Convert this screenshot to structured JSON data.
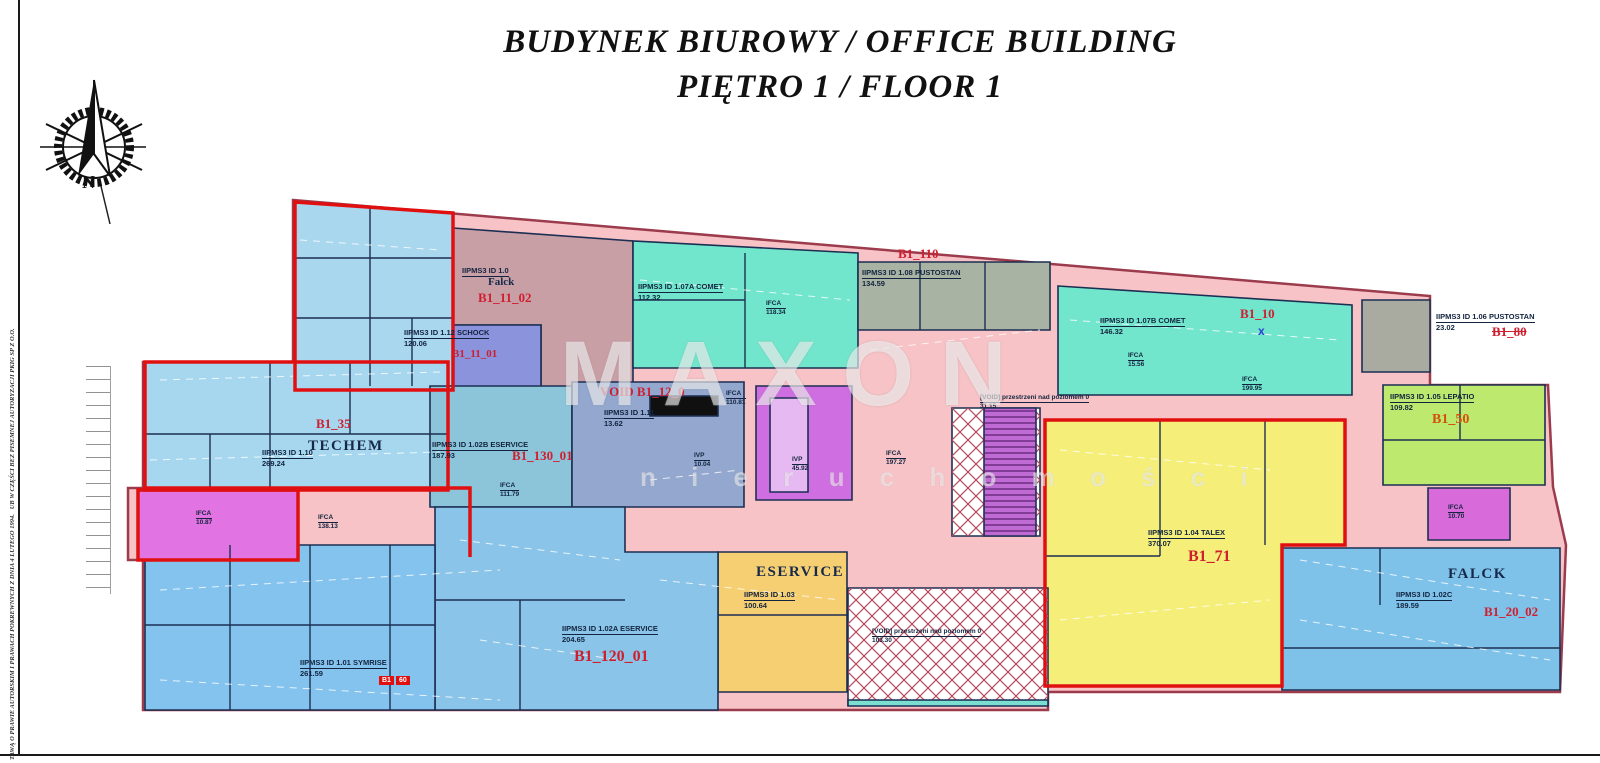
{
  "header": {
    "title_line1": "BUDYNEK BIUROWY / OFFICE BUILDING",
    "title_line2": "PIĘTRO 1 / FLOOR 1"
  },
  "compass": {
    "north_label": "N"
  },
  "side_note": {
    "line1": "TAWĄ O PRAWIE AUTORSKIM I PRAWACH POKREWNYCH Z DNIA 4 LUTEGO 1994.",
    "line2": "UB W CZĘŚCI BEZ PISEMNEJ AUTORYZACJI PKIG SP Z O.O."
  },
  "watermark": {
    "line1": "MAXON",
    "line2": "n i e r u c h o m o ś c i"
  },
  "colors": {
    "wall": "#1c2f52",
    "outline_red": "#e01010",
    "base_pink": "#f7c3c7",
    "teal": "#72e6cc",
    "yellow": "#f5ef7a",
    "gold": "#f6cf72",
    "green": "#bdea6e",
    "magenta": "#cf6ee0",
    "blue": "#85c3ef"
  },
  "plan": {
    "zones": [
      {
        "name": "base-building",
        "fill": "#f7c3c7",
        "stroke": "#9b3b4b",
        "sw": 2.5,
        "points": "293,200 1430,296 1430,385 1548,385 1553,487 1566,545 1560,692 1048,692 1048,710 143,710 143,560 128,560 128,488 143,488 143,362 293,362"
      },
      {
        "name": "cluster-nw",
        "fill": "#a9d7ee",
        "points": "295,202 453,213 453,386 295,386"
      },
      {
        "name": "falck-1",
        "fill": "#c99fa6",
        "points": "453,228 633,241 633,388 541,388 541,325 453,325"
      },
      {
        "name": "comet-a",
        "fill": "#72e6cc",
        "points": "633,241 858,253 858,368 633,368"
      },
      {
        "name": "schock",
        "fill": "#8a93dc",
        "points": "453,325 541,325 541,388 453,388"
      },
      {
        "name": "pustostan-108",
        "fill": "#a9b3a4",
        "points": "858,262 1050,262 1050,330 858,330"
      },
      {
        "name": "comet-b",
        "fill": "#72e6cc",
        "points": "1058,286 1352,305 1352,395 1058,395"
      },
      {
        "name": "pustostan-106",
        "fill": "#a9aba0",
        "points": "1362,300 1430,300 1430,372 1362,372"
      },
      {
        "name": "lepatio",
        "fill": "#bdea6e",
        "points": "1383,385 1545,385 1545,485 1383,485"
      },
      {
        "name": "techem",
        "fill": "#a6d7ef",
        "points": "145,362 448,362 448,490 145,490"
      },
      {
        "name": "eservice-b",
        "fill": "#8cc5d9",
        "points": "430,386 572,386 572,507 430,507"
      },
      {
        "name": "void-12",
        "fill": "#93a7cf",
        "points": "572,382 744,382 744,507 572,507"
      },
      {
        "name": "elevator-block",
        "fill": "#101010",
        "points": "650,396 718,396 718,416 650,416"
      },
      {
        "name": "core-stairs",
        "fill": "#cf6ee0",
        "points": "756,386 852,386 852,500 756,500"
      },
      {
        "name": "core-stairs-inner",
        "fill": "#e7b9f2",
        "points": "770,398 808,398 808,492 770,492"
      },
      {
        "name": "void-hatch-top",
        "fill": "#ffffff",
        "pattern": "xh",
        "points": "952,408 1040,408 1040,536 952,536"
      },
      {
        "name": "stair-top",
        "fill": "#c06ad4",
        "pattern": "st",
        "points": "984,408 1036,408 1036,536 984,536"
      },
      {
        "name": "talex",
        "fill": "#f5ef7a",
        "points": "1045,420 1345,420 1345,545 1282,545 1282,686 1045,686"
      },
      {
        "name": "ifca-1070",
        "fill": "#d96ad9",
        "points": "1428,488 1510,488 1510,540 1428,540"
      },
      {
        "name": "falck-c",
        "fill": "#7fc2e9",
        "points": "1282,548 1560,548 1560,690 1282,690"
      },
      {
        "name": "eservice-103",
        "fill": "#f6cf72",
        "points": "718,552 847,552 847,692 718,692"
      },
      {
        "name": "eservice-a",
        "fill": "#8ac4e8",
        "points": "435,507 625,507 625,552 718,552 718,710 435,710"
      },
      {
        "name": "symrise",
        "fill": "#85c3ef",
        "points": "145,545 435,545 435,710 145,710"
      },
      {
        "name": "stairs-left",
        "fill": "#e273e2",
        "points": "138,490 298,490 298,560 138,560"
      },
      {
        "name": "void-hatch-bottom",
        "fill": "#ffffff",
        "pattern": "xh",
        "points": "848,588 1048,588 1048,705 848,705"
      },
      {
        "name": "teal-strip",
        "fill": "#7adfd0",
        "points": "848,700 1048,700 1048,706 848,706"
      }
    ],
    "red_outlines": [
      "295,202 453,213 453,390 295,390",
      "145,362 448,362 448,490 145,490",
      "1045,420 1345,420 1345,545 1282,545 1282,686 1045,686",
      "138,490 298,490 298,560 138,560"
    ],
    "red_lines": [
      "143,488 470,488 470,557"
    ],
    "partitions": [
      [
        370,
        206,
        370,
        386
      ],
      [
        295,
        258,
        453,
        258
      ],
      [
        295,
        318,
        453,
        318
      ],
      [
        412,
        318,
        412,
        386
      ],
      [
        270,
        362,
        270,
        490
      ],
      [
        350,
        362,
        350,
        434
      ],
      [
        145,
        434,
        448,
        434
      ],
      [
        210,
        434,
        210,
        490
      ],
      [
        745,
        253,
        745,
        368
      ],
      [
        633,
        300,
        745,
        300
      ],
      [
        920,
        262,
        920,
        330
      ],
      [
        985,
        262,
        985,
        330
      ],
      [
        1160,
        420,
        1160,
        556
      ],
      [
        1265,
        420,
        1265,
        545
      ],
      [
        1045,
        556,
        1160,
        556
      ],
      [
        230,
        545,
        230,
        710
      ],
      [
        310,
        545,
        310,
        710
      ],
      [
        390,
        545,
        390,
        710
      ],
      [
        145,
        625,
        435,
        625
      ],
      [
        435,
        600,
        625,
        600
      ],
      [
        520,
        600,
        520,
        710
      ],
      [
        718,
        615,
        847,
        615
      ],
      [
        1380,
        548,
        1380,
        605
      ],
      [
        1282,
        648,
        1560,
        648
      ],
      [
        1460,
        385,
        1460,
        440
      ],
      [
        1383,
        440,
        1545,
        440
      ]
    ],
    "dashes": [
      [
        300,
        240,
        440,
        250
      ],
      [
        640,
        280,
        850,
        300
      ],
      [
        1070,
        320,
        1340,
        340
      ],
      [
        1300,
        560,
        1550,
        600
      ],
      [
        1300,
        620,
        1550,
        660
      ],
      [
        460,
        540,
        620,
        560
      ],
      [
        480,
        640,
        620,
        660
      ],
      [
        660,
        580,
        840,
        600
      ],
      [
        1060,
        450,
        1270,
        470
      ],
      [
        1060,
        620,
        1270,
        600
      ],
      [
        160,
        590,
        500,
        570
      ],
      [
        160,
        680,
        500,
        700
      ],
      [
        870,
        350,
        1040,
        330
      ],
      [
        650,
        480,
        740,
        470
      ],
      [
        160,
        380,
        440,
        372
      ],
      [
        150,
        460,
        440,
        452
      ]
    ],
    "labels": [
      {
        "cls": "t1",
        "x": 462,
        "y": 266,
        "lines": [
          "IIPMS3 ID 1.0"
        ]
      },
      {
        "cls": "mid",
        "x": 488,
        "y": 276,
        "lines": [
          "Falck"
        ]
      },
      {
        "cls": "rid",
        "x": 478,
        "y": 290,
        "lines": [
          "B1_11_02"
        ]
      },
      {
        "cls": "t1",
        "x": 404,
        "y": 328,
        "lines": [
          "IIPMS3 ID 1.12 SCHOCK",
          "120.06"
        ]
      },
      {
        "cls": "rid12",
        "x": 452,
        "y": 348,
        "lines": [
          "B1_11_01"
        ]
      },
      {
        "cls": "t1",
        "x": 638,
        "y": 282,
        "lines": [
          "IIPMS3 ID 1.07A COMET",
          "112.32"
        ]
      },
      {
        "cls": "tiny",
        "x": 766,
        "y": 300,
        "lines": [
          "IFCA",
          "118.34"
        ]
      },
      {
        "cls": "rid",
        "x": 898,
        "y": 246,
        "lines": [
          "B1_110"
        ]
      },
      {
        "cls": "t1",
        "x": 862,
        "y": 268,
        "lines": [
          "IIPMS3 ID 1.08 PUSTOSTAN",
          "134.59"
        ]
      },
      {
        "cls": "t1",
        "x": 1100,
        "y": 316,
        "lines": [
          "IIPMS3 ID 1.07B COMET",
          "146.32"
        ]
      },
      {
        "cls": "rid",
        "x": 1240,
        "y": 306,
        "lines": [
          "B1_10"
        ]
      },
      {
        "cls": "bx",
        "x": 1258,
        "y": 324,
        "lines": [
          "x"
        ]
      },
      {
        "cls": "tiny",
        "x": 1128,
        "y": 352,
        "lines": [
          "IFCA",
          "15.56"
        ]
      },
      {
        "cls": "tiny",
        "x": 1242,
        "y": 376,
        "lines": [
          "IFCA",
          "199.95"
        ]
      },
      {
        "cls": "t1",
        "x": 1436,
        "y": 312,
        "lines": [
          "IIPMS3 ID 1.06 PUSTOSTAN",
          "23.02"
        ]
      },
      {
        "cls": "ridS",
        "x": 1492,
        "y": 324,
        "lines": [
          "B1_80"
        ]
      },
      {
        "cls": "t1",
        "x": 1390,
        "y": 392,
        "lines": [
          "IIPMS3 ID 1.05 LEPATIO",
          "109.82"
        ]
      },
      {
        "cls": "ridO",
        "x": 1432,
        "y": 412,
        "lines": [
          "B1_50"
        ]
      },
      {
        "cls": "rid",
        "x": 316,
        "y": 416,
        "lines": [
          "B1_35"
        ]
      },
      {
        "cls": "big",
        "x": 308,
        "y": 438,
        "lines": [
          "TECHEM"
        ]
      },
      {
        "cls": "t1",
        "x": 262,
        "y": 448,
        "lines": [
          "IIPMS3 ID 1.10",
          "269.24"
        ]
      },
      {
        "cls": "t1",
        "x": 432,
        "y": 440,
        "lines": [
          "IIPMS3 ID 1.02B ESERVICE",
          "187.93"
        ]
      },
      {
        "cls": "rid",
        "x": 512,
        "y": 448,
        "lines": [
          "B1_130_01"
        ]
      },
      {
        "cls": "rid",
        "x": 600,
        "y": 384,
        "lines": [
          "VOID B1_12_0"
        ]
      },
      {
        "cls": "t1",
        "x": 604,
        "y": 408,
        "lines": [
          "IIPMS3 ID 1.11",
          "13.62"
        ]
      },
      {
        "cls": "tiny",
        "x": 726,
        "y": 390,
        "lines": [
          "IFCA",
          "110.81"
        ]
      },
      {
        "cls": "tiny",
        "x": 694,
        "y": 452,
        "lines": [
          "IVP",
          "10.04"
        ]
      },
      {
        "cls": "tiny",
        "x": 792,
        "y": 456,
        "lines": [
          "IVP",
          "45.92"
        ]
      },
      {
        "cls": "tiny",
        "x": 500,
        "y": 482,
        "lines": [
          "IFCA",
          "111.79"
        ]
      },
      {
        "cls": "tiny",
        "x": 886,
        "y": 450,
        "lines": [
          "IFCA",
          "197.27"
        ]
      },
      {
        "cls": "tiny7",
        "x": 980,
        "y": 394,
        "lines": [
          "[VOID] przestrzeni nad poziomem 0",
          "31.15"
        ]
      },
      {
        "cls": "t1",
        "x": 1148,
        "y": 528,
        "lines": [
          "IIPMS3 ID 1.04 TALEX",
          "370.07"
        ]
      },
      {
        "cls": "rid16",
        "x": 1188,
        "y": 548,
        "lines": [
          "B1_71"
        ]
      },
      {
        "cls": "big",
        "x": 1448,
        "y": 566,
        "lines": [
          "FALCK"
        ]
      },
      {
        "cls": "t1",
        "x": 1396,
        "y": 590,
        "lines": [
          "IIPMS3 ID 1.02C",
          "189.59"
        ]
      },
      {
        "cls": "rid",
        "x": 1484,
        "y": 604,
        "lines": [
          "B1_20_02"
        ]
      },
      {
        "cls": "big",
        "x": 756,
        "y": 564,
        "lines": [
          "ESERVICE"
        ]
      },
      {
        "cls": "t1",
        "x": 744,
        "y": 590,
        "lines": [
          "IIPMS3 ID 1.03",
          "100.64"
        ]
      },
      {
        "cls": "t1",
        "x": 562,
        "y": 624,
        "lines": [
          "IIPMS3 ID 1.02A ESERVICE",
          "204.65"
        ]
      },
      {
        "cls": "rid16",
        "x": 574,
        "y": 648,
        "lines": [
          "B1_120_01"
        ]
      },
      {
        "cls": "t1",
        "x": 300,
        "y": 658,
        "lines": [
          "IIPMS3 ID 1.01 SYMRISE",
          "261.59"
        ]
      },
      {
        "cls": "hl",
        "x": 378,
        "y": 668,
        "lines": [
          "B1",
          "60"
        ]
      },
      {
        "cls": "tiny",
        "x": 318,
        "y": 514,
        "lines": [
          "IFCA",
          "138.13"
        ]
      },
      {
        "cls": "tiny",
        "x": 196,
        "y": 510,
        "lines": [
          "IFCA",
          "10.87"
        ]
      },
      {
        "cls": "tiny",
        "x": 1448,
        "y": 504,
        "lines": [
          "IFCA",
          "10.70"
        ]
      },
      {
        "cls": "tiny7",
        "x": 872,
        "y": 628,
        "lines": [
          "[VOID] przestrzeni nad poziomem 0",
          "103.30"
        ]
      }
    ]
  }
}
